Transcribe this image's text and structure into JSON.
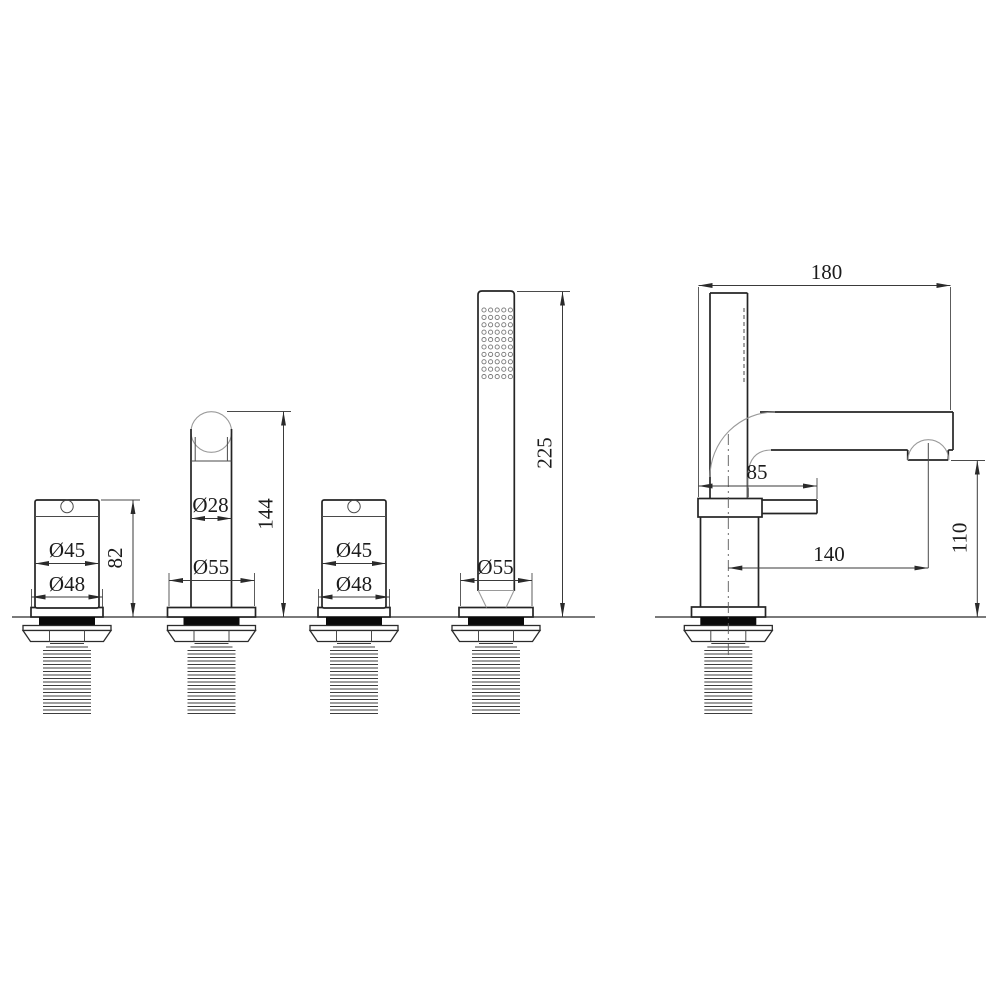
{
  "drawing": {
    "handle_left": {
      "dia_top": "Ø45",
      "dia_base": "Ø48",
      "height": "82"
    },
    "spout": {
      "dia_top": "Ø28",
      "dia_base": "Ø55",
      "height": "144"
    },
    "handle_right": {
      "dia_top": "Ø45",
      "dia_base": "Ø48"
    },
    "hand_shower": {
      "dia_base": "Ø55",
      "height": "225"
    },
    "side_view": {
      "overall_depth": "180",
      "lever_reach": "85",
      "spout_reach": "140",
      "outlet_height": "110"
    }
  }
}
